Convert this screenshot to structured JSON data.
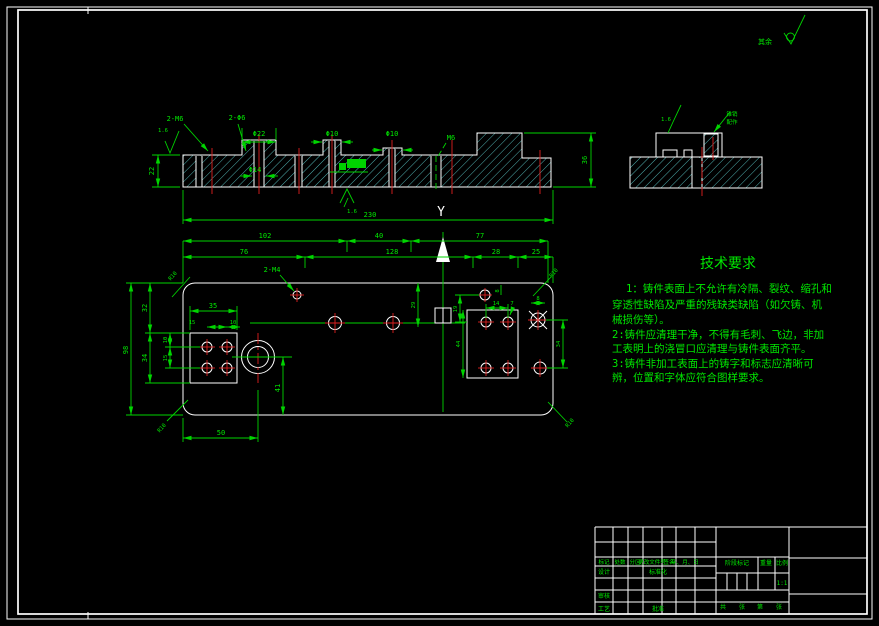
{
  "colors": {
    "background": "#000000",
    "geometry_line": "#ffffff",
    "hatch": "#66e0e0",
    "centerline": "#e02020",
    "dimension": "#00d400",
    "text": "#00e800"
  },
  "surface_note": {
    "label": "其余"
  },
  "front_view": {
    "d_2m6": "2-M6",
    "d_2phi6": "2-Φ6",
    "d_phi22": "Φ22",
    "d_phi14": "Φ14",
    "d_phi10a": "Φ10",
    "d_phi10b": "Φ10",
    "d_m6": "M6",
    "d_22": "22",
    "d_230": "230",
    "d_36": "36",
    "rough_left": "1.6",
    "rough_bottom": "1.6"
  },
  "side_view": {
    "rough": "1.6",
    "leader_line1": "锥销",
    "leader_line2": "配作"
  },
  "plan_view": {
    "section_label": "Y",
    "d_102": "102",
    "d_40": "40",
    "d_77": "77",
    "d_76": "76",
    "d_128": "128",
    "d_28": "28",
    "d_25": "25",
    "d_2m4": "2-M4",
    "d_98": "98",
    "d_32": "32",
    "d_34": "34",
    "d_10": "10",
    "d_15": "15",
    "d_35": "35",
    "d_15b": "15",
    "d_10b": "10",
    "d_41": "41",
    "d_50": "50",
    "d_14": "14",
    "d_7": "7",
    "d_8": "8",
    "d_8b": "8",
    "d_19": "19",
    "d_29": "29",
    "d_44": "44",
    "d_34b": "34",
    "r10_tl": "R10",
    "r10_bl": "R10",
    "r10_tr": "R10",
    "r10_br": "R10"
  },
  "tech_requirements": {
    "title": "技术要求",
    "lines": [
      "1：铸件表面上不允许有冷隔、裂纹、缩孔和",
      "穿透性缺陷及严重的残缺类缺陷（如欠铸、机",
      "械损伤等）。",
      "2:铸件应清理干净，不得有毛刺、飞边，非加",
      "工表明上的浇冒口应清理与铸件表面齐平。",
      "3:铸件非加工表面上的铸字和标志应清晰可",
      "辨，位置和字体应符合图样要求。"
    ]
  },
  "title_block": {
    "headers": [
      "标记",
      "处数",
      "分区",
      "更改文件号",
      "签名",
      "年、月、日"
    ],
    "design": "设计",
    "standardize": "标准化",
    "review": "审核",
    "process": "工艺",
    "approve": "批准",
    "stage_mark": "阶段标记",
    "weight": "重量",
    "scale": "比例",
    "scale_value": "1:1",
    "total_label": "共",
    "sheet_label": "张",
    "page_label": "第",
    "page_label2": "张"
  }
}
